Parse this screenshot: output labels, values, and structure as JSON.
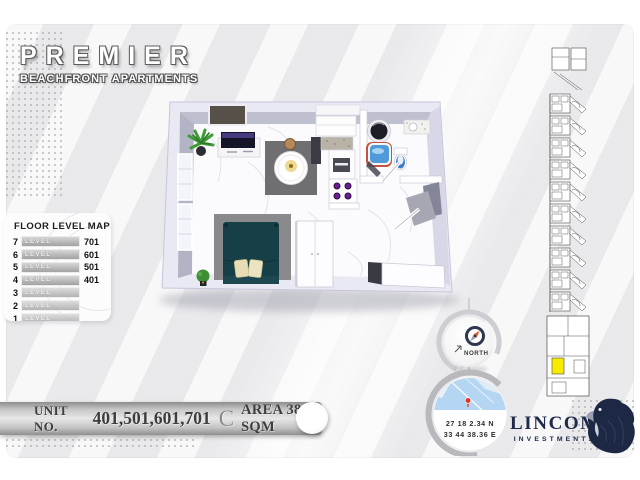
{
  "logo": {
    "title": "PREMIER",
    "subtitle": "BEACHFRONT APARTMENTS"
  },
  "floor_level_map": {
    "title": "FLOOR LEVEL MAP",
    "levels": [
      {
        "floor": "7",
        "label": "LEVEL",
        "unit": "701"
      },
      {
        "floor": "6",
        "label": "LEVEL",
        "unit": "601"
      },
      {
        "floor": "5",
        "label": "LEVEL",
        "unit": "501"
      },
      {
        "floor": "4",
        "label": "LEVEL",
        "unit": "401"
      },
      {
        "floor": "3",
        "label": "LEVEL",
        "unit": ""
      },
      {
        "floor": "2",
        "label": "LEVEL",
        "unit": ""
      },
      {
        "floor": "1",
        "label": "LEVEL",
        "unit": ""
      }
    ]
  },
  "unit_banner": {
    "unit_no_label": "UNIT NO.",
    "unit_numbers": "401,501,601,701",
    "type_letter": "C",
    "area_label": "AREA 38 SQM"
  },
  "compass": {
    "label": "NORTH"
  },
  "location": {
    "latitude": "27 18 2.34 N",
    "longitude": "33 44 38.36 E"
  },
  "brand": {
    "name": "LINCOM",
    "subtitle": "INVESTMENTS"
  },
  "colors": {
    "brand_navy": "#1d2a4a",
    "keyplan_highlight_yellow": "#f7ec00",
    "map_pin_red": "#e0372a",
    "compass_needle_orange": "#d9572e",
    "bed_teal": "#173f48",
    "burner_purple": "#6b1e94"
  }
}
